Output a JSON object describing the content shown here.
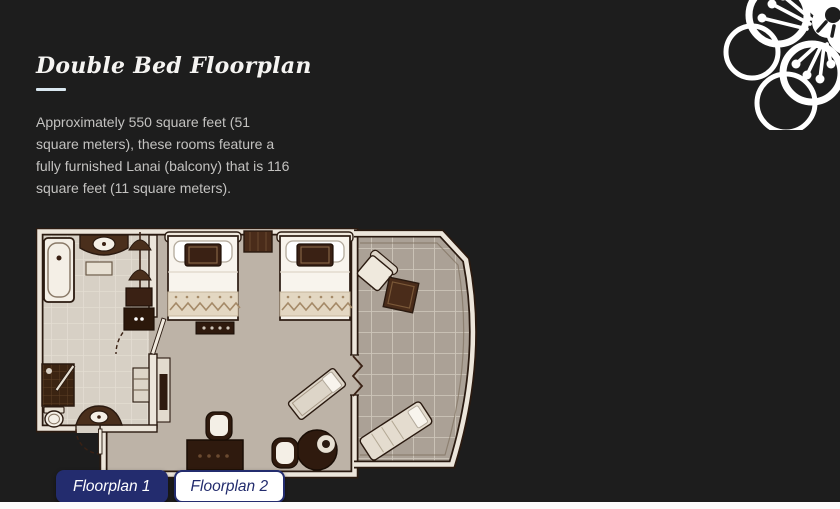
{
  "header": {
    "title": "Double Bed Floorplan"
  },
  "description": {
    "text": "Approximately 550 square feet (51 square meters), these rooms feature a fully furnished Lanai (balcony) that is 116 square feet (11 square meters).",
    "lines": [
      "Approximately 550 square feet (51",
      "square meters), these rooms feature a",
      "fully furnished Lanai (balcony) that is 116",
      "square feet (11 square meters)."
    ]
  },
  "tabs": [
    {
      "label": "Floorplan 1",
      "active": true
    },
    {
      "label": "Floorplan 2",
      "active": false
    }
  ],
  "floorplan": {
    "name": "double-bed-room-floorplan",
    "palette": {
      "walls": "#ece5da",
      "carpet": "#bdb3a7",
      "balcony_tile": "#aba196",
      "bathroom_tile": "#d7d0c5",
      "furniture_dark": "#3a2114",
      "linen": "#f8f4ed"
    }
  },
  "ornament": {
    "name": "plum-blossom-ornament",
    "color": "#ffffff"
  },
  "colors": {
    "background": "#1d1d1d",
    "accent_navy": "#232c6e",
    "title_text": "#f5f4f2",
    "body_text": "#c3c2c0",
    "divider": "#d9e7f0",
    "bottom_strip": "#fcfcfc"
  }
}
